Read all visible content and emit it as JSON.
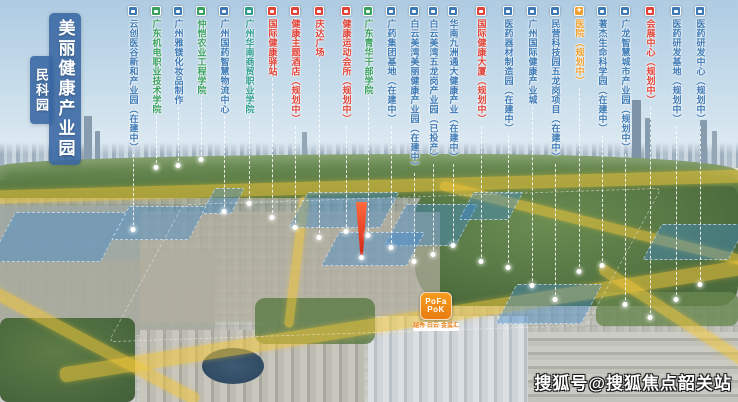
{
  "title": {
    "main": "美丽健康产业园",
    "sub": "民科园"
  },
  "watermark": "搜狐号@搜狐焦点韶关站",
  "logo": {
    "line1": "PoFa",
    "line2": "PoK",
    "tagline": "越秀·白云·金玺汇"
  },
  "legend_colors": {
    "blue": "#3d7ab5",
    "green": "#3aa05f",
    "teal": "#2f9e8f",
    "red": "#e04338",
    "orange": "#efa02f"
  },
  "callouts": [
    {
      "label": "云创医谷新和产业园（在建中）",
      "type": "blue",
      "x": 133,
      "drop": 230
    },
    {
      "label": "广东机电职业技术学院",
      "type": "green",
      "x": 156,
      "drop": 168
    },
    {
      "label": "广州雅镁化妆品制作",
      "type": "blue",
      "x": 178,
      "drop": 166
    },
    {
      "label": "仲恺农业工程学院",
      "type": "green",
      "x": 201,
      "drop": 160
    },
    {
      "label": "广州国药智慧物流中心",
      "type": "blue",
      "x": 224,
      "drop": 212
    },
    {
      "label": "广州华南商贸职业学院",
      "type": "teal",
      "x": 249,
      "drop": 204
    },
    {
      "label": "国际健康驿站",
      "type": "red",
      "x": 272,
      "drop": 218
    },
    {
      "label": "健康主题酒店（规划中）",
      "type": "red",
      "x": 295,
      "drop": 228
    },
    {
      "label": "庆达广场",
      "type": "red",
      "x": 319,
      "drop": 238
    },
    {
      "label": "健康运动会所（规划中）",
      "type": "red",
      "x": 346,
      "drop": 232
    },
    {
      "label": "广东青华干部学院",
      "type": "green",
      "x": 368,
      "drop": 236
    },
    {
      "label": "广药集团基地（在建中）",
      "type": "blue",
      "x": 391,
      "drop": 248
    },
    {
      "label": "白云美湾美丽健康产业园（在建中）",
      "type": "blue",
      "x": 414,
      "drop": 262
    },
    {
      "label": "白云美湾五龙岗产业园（已投产）",
      "type": "blue",
      "x": 433,
      "drop": 255
    },
    {
      "label": "华南九洲通大健康产业（在建中）",
      "type": "blue",
      "x": 453,
      "drop": 246
    },
    {
      "label": "国际健康大厦（规划中）",
      "type": "red",
      "x": 481,
      "drop": 262
    },
    {
      "label": "医药器材制造园（在建中）",
      "type": "blue",
      "x": 508,
      "drop": 268
    },
    {
      "label": "广州国际健康产业城",
      "type": "blue",
      "x": 532,
      "drop": 286
    },
    {
      "label": "民营科技园五龙岗项目（在建中）",
      "type": "blue",
      "x": 555,
      "drop": 300
    },
    {
      "label": "医院（规划中）",
      "type": "orange",
      "x": 579,
      "drop": 272
    },
    {
      "label": "著杰生命科学园（在建中）",
      "type": "blue",
      "x": 602,
      "drop": 266
    },
    {
      "label": "广龙智慧城市产业园（规划中）",
      "type": "blue",
      "x": 625,
      "drop": 305
    },
    {
      "label": "会展中心（规划中）",
      "type": "red",
      "x": 650,
      "drop": 318
    },
    {
      "label": "医药研发基地（规划中）",
      "type": "blue",
      "x": 676,
      "drop": 300
    },
    {
      "label": "医药研发中心（规划中）",
      "type": "blue",
      "x": 700,
      "drop": 285
    }
  ]
}
